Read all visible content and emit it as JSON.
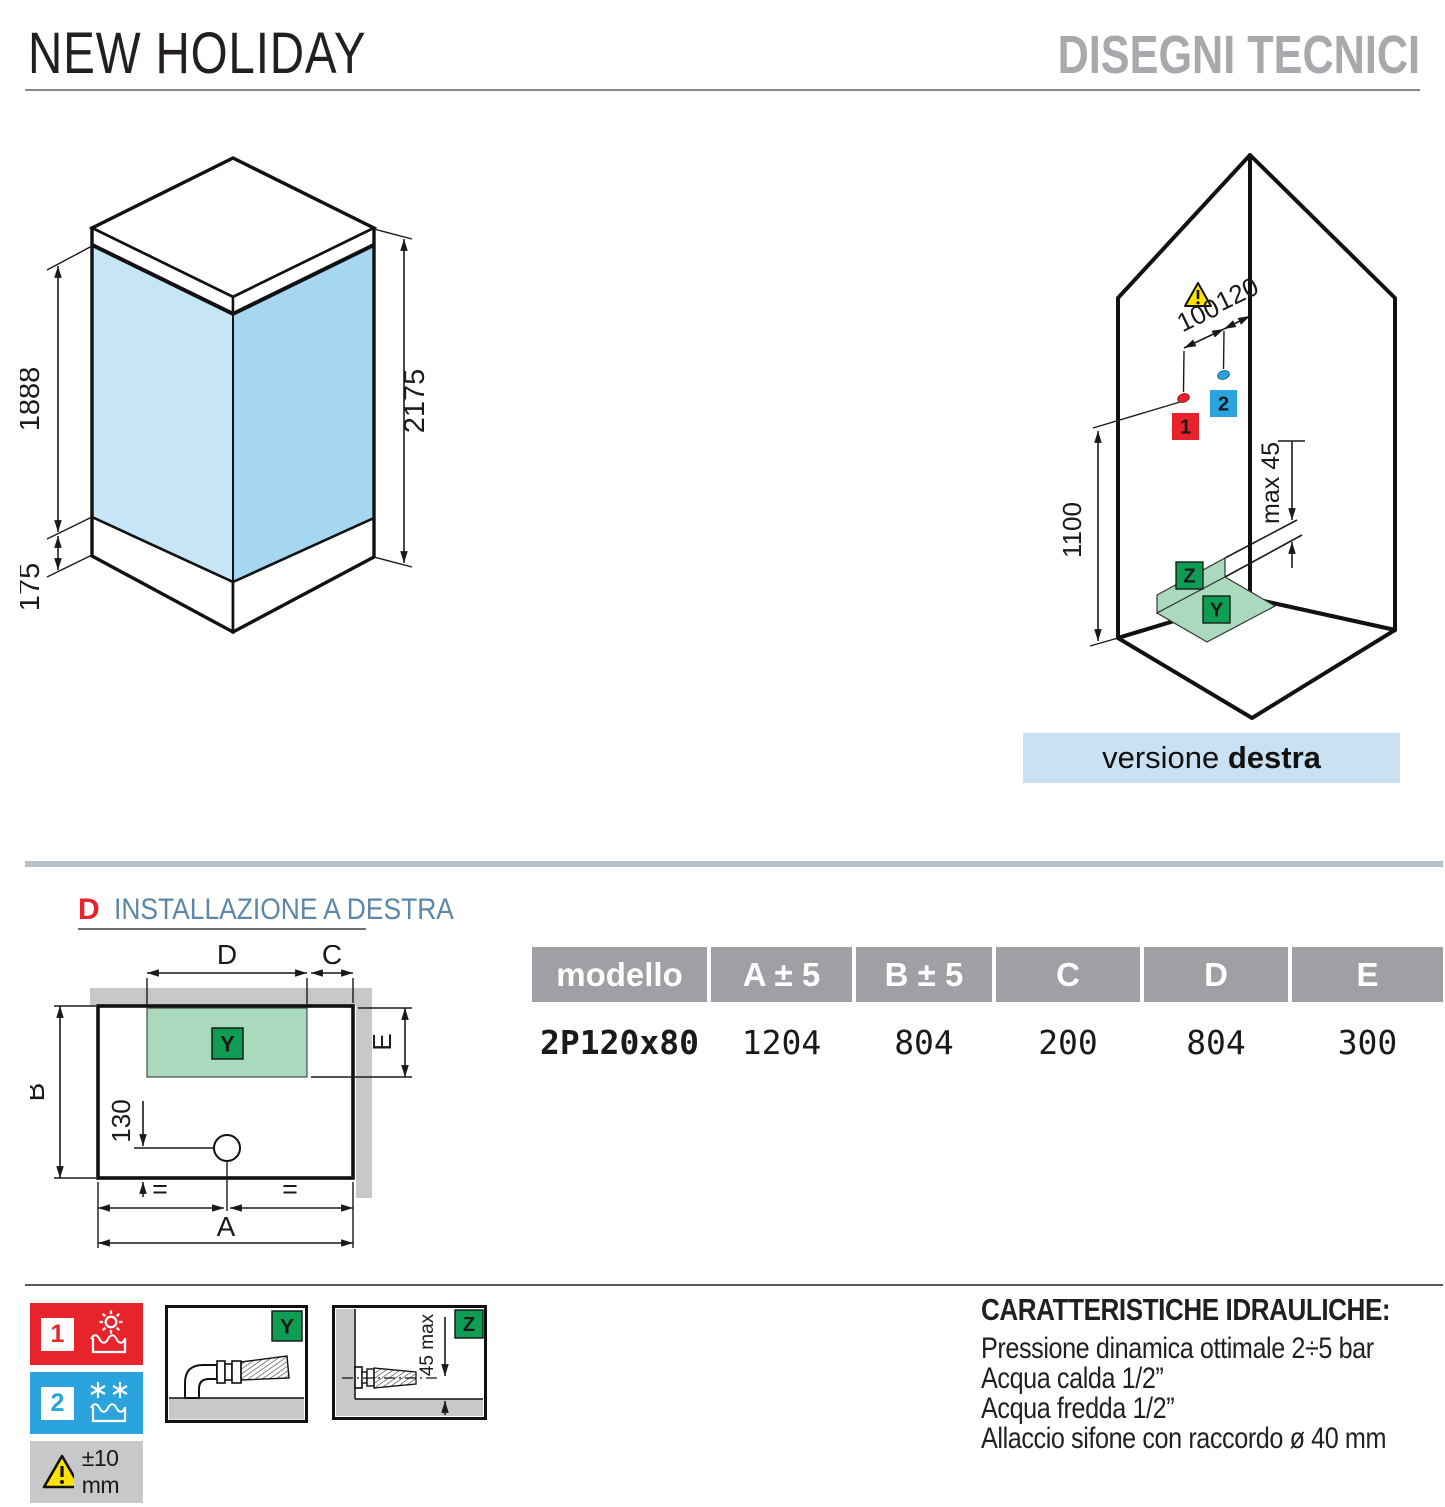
{
  "header": {
    "product_title": "NEW HOLIDAY",
    "page_title": "DISEGNI TECNICI"
  },
  "iso_cabin": {
    "dim_glass_height": "1888",
    "dim_base_height": "175",
    "dim_total_height": "2175"
  },
  "iso_install": {
    "dim_hot_cold_spacing": "100",
    "dim_corner_offset": "120",
    "dim_mixer_height": "1100",
    "dim_max_label": "max 45",
    "hot_marker": "1",
    "cold_marker": "2",
    "wall_zone": "Z",
    "floor_zone": "Y"
  },
  "version_bar": {
    "text_regular": "versione ",
    "text_bold": "destra"
  },
  "plan": {
    "marker": "D",
    "title": "INSTALLAZIONE A DESTRA",
    "dim_d": "D",
    "dim_c": "C",
    "dim_e": "E",
    "dim_b": "B",
    "dim_a": "A",
    "dim_drain": "130",
    "equal_left": "=",
    "equal_right": "=",
    "zone": "Y"
  },
  "table": {
    "headers": [
      "modello",
      "A ± 5",
      "B ± 5",
      "C",
      "D",
      "E"
    ],
    "row": [
      "2P120x80",
      "1204",
      "804",
      "200",
      "804",
      "300"
    ]
  },
  "legend": {
    "hot_number": "1",
    "cold_number": "2",
    "tolerance": "±10 mm"
  },
  "detail_y": {
    "zone": "Y"
  },
  "detail_z": {
    "zone": "Z",
    "dim": "45 max"
  },
  "hydraulics": {
    "title": "CARATTERISTICHE IDRAULICHE:",
    "lines": [
      "Pressione dinamica ottimale 2÷5 bar",
      "Acqua calda 1/2”",
      "Acqua fredda 1/2”",
      "Allaccio sifone con raccordo ø 40 mm"
    ]
  },
  "colors": {
    "accent_red": "#e8232b",
    "accent_blue": "#2ba3dc",
    "accent_green": "#0f9c53",
    "zone_green_light": "#aadabe",
    "glass_blue_left": "#c6e6f7",
    "glass_blue_right": "#a5d7f0",
    "version_bar_bg": "#c9e1f2",
    "divider_blue_gray": "#b2c3cd",
    "table_header_gray": "#9ea0a3",
    "neutral_gray": "#c7c8ca",
    "title_gray": "#a7a9ac",
    "plan_title_blue": "#5d87a9",
    "warning_yellow": "#ffe200"
  }
}
